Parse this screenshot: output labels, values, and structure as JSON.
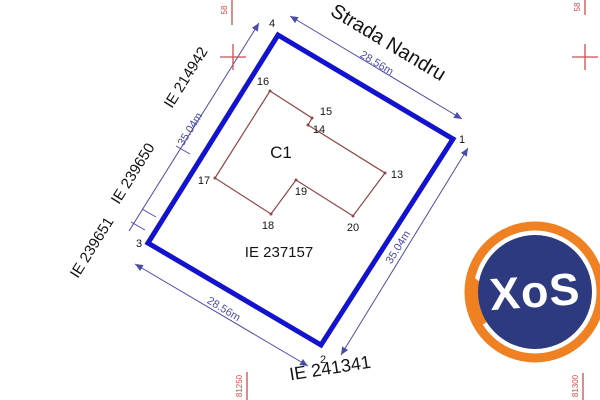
{
  "street": {
    "name": "Strada Nandru"
  },
  "parcel": {
    "cadastral_id": "IE 237157",
    "road_parcel_id": "IE 241341",
    "dim_top": "28.56m",
    "dim_right": "35.04m",
    "dim_bottom": "28.56m",
    "dim_left": "35.04m",
    "vertex_1": "1",
    "vertex_2": "2",
    "vertex_3": "3",
    "vertex_4": "4"
  },
  "building": {
    "label": "C1",
    "vertex_13": "13",
    "vertex_14": "14",
    "vertex_15": "15",
    "vertex_16": "16",
    "vertex_17": "17",
    "vertex_18": "18",
    "vertex_19": "19",
    "vertex_20": "20"
  },
  "neighbors": {
    "upper_left": "IE 214942",
    "middle_left": "IE 239650",
    "lower_left": "IE 239651"
  },
  "grid": {
    "top_left_label": "58",
    "top_right_label": "58",
    "bottom_left_label": "81250",
    "bottom_right_label": "81300"
  },
  "watermark": {
    "text": "XoS"
  },
  "colors": {
    "boundary": "#1212cf",
    "building": "#8e4545",
    "dimension": "#4b4ba8",
    "grid": "#c94f4f",
    "ink": "#141414",
    "logo-orange": "#ef8122",
    "logo-navy": "#2d3a80",
    "logo-text": "#ffffff",
    "bg": "#ffffff"
  }
}
